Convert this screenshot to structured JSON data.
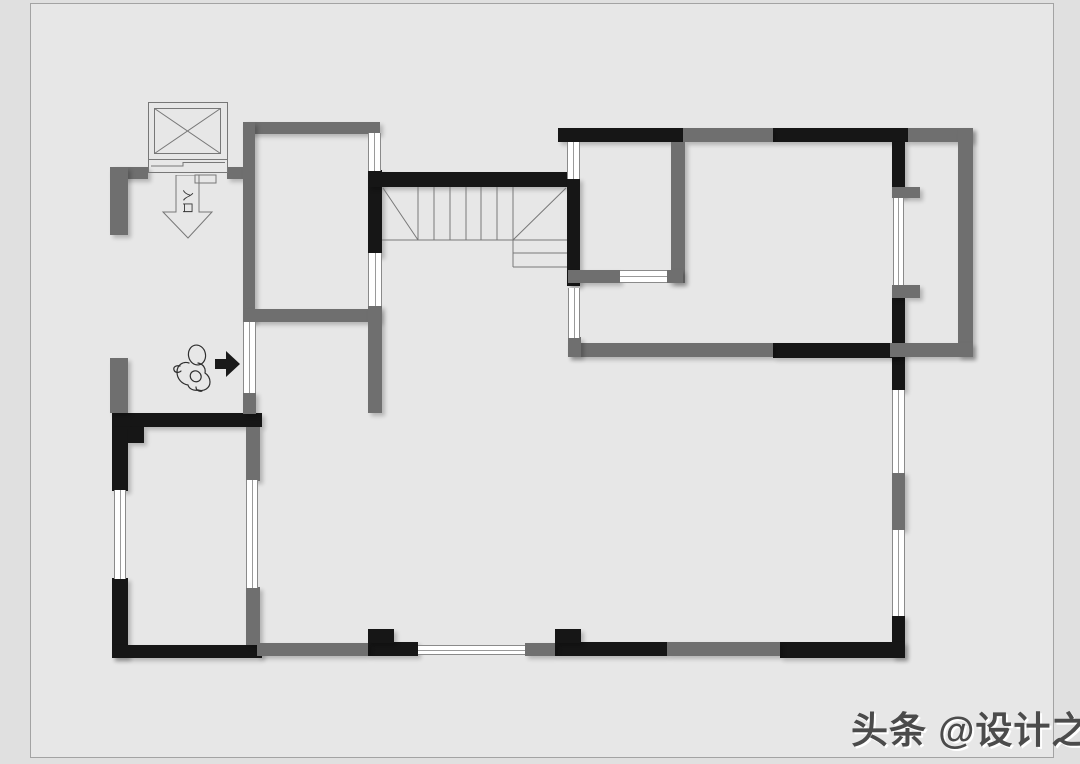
{
  "page": {
    "outer_bg": "#e0e0e0",
    "canvas_bg": "#e7e7e7",
    "canvas_border": "#a3a3a3"
  },
  "palette": {
    "wall_black": "#161616",
    "wall_gray": "#6f6f6f",
    "thin_line": "#777777",
    "window_fill": "#ffffff",
    "arrow_fill": "#1a1a1a",
    "watermark_color": "#4b4b4b"
  },
  "entry": {
    "label": "入口"
  },
  "watermark": {
    "text": "头条 @设计之师"
  },
  "floorplan": {
    "walls_black": [
      [
        368,
        170,
        14,
        86
      ],
      [
        368,
        172,
        205,
        15
      ],
      [
        558,
        128,
        125,
        14
      ],
      [
        567,
        178,
        13,
        108
      ],
      [
        773,
        128,
        135,
        14
      ],
      [
        892,
        142,
        13,
        54
      ],
      [
        892,
        298,
        13,
        93
      ],
      [
        773,
        343,
        125,
        15
      ],
      [
        892,
        615,
        13,
        43
      ],
      [
        780,
        642,
        125,
        16
      ],
      [
        555,
        642,
        112,
        14
      ],
      [
        555,
        629,
        26,
        14
      ],
      [
        368,
        642,
        50,
        14
      ],
      [
        368,
        629,
        26,
        14
      ],
      [
        112,
        413,
        150,
        14
      ],
      [
        112,
        427,
        16,
        64
      ],
      [
        112,
        578,
        16,
        80
      ],
      [
        112,
        645,
        150,
        13
      ],
      [
        128,
        427,
        16,
        16
      ]
    ],
    "walls_gray": [
      [
        110,
        167,
        38,
        12
      ],
      [
        227,
        167,
        16,
        12
      ],
      [
        110,
        167,
        18,
        68
      ],
      [
        243,
        122,
        137,
        12
      ],
      [
        243,
        122,
        12,
        200
      ],
      [
        243,
        309,
        137,
        13
      ],
      [
        243,
        392,
        13,
        22
      ],
      [
        368,
        305,
        14,
        108
      ],
      [
        683,
        128,
        90,
        14
      ],
      [
        908,
        128,
        65,
        14
      ],
      [
        958,
        128,
        15,
        229
      ],
      [
        890,
        343,
        83,
        14
      ],
      [
        892,
        187,
        28,
        11
      ],
      [
        892,
        285,
        28,
        13
      ],
      [
        671,
        142,
        14,
        141
      ],
      [
        568,
        270,
        52,
        13
      ],
      [
        667,
        270,
        16,
        13
      ],
      [
        568,
        343,
        205,
        14
      ],
      [
        568,
        337,
        13,
        20
      ],
      [
        110,
        358,
        18,
        55
      ],
      [
        246,
        427,
        14,
        54
      ],
      [
        246,
        587,
        14,
        58
      ],
      [
        257,
        643,
        111,
        13
      ],
      [
        525,
        643,
        30,
        13
      ],
      [
        667,
        642,
        113,
        14
      ],
      [
        892,
        472,
        13,
        58
      ]
    ],
    "windows": [
      [
        368,
        133,
        13,
        38,
        "v"
      ],
      [
        567,
        142,
        13,
        37,
        "v"
      ],
      [
        620,
        270,
        47,
        13,
        "h"
      ],
      [
        893,
        198,
        11,
        87,
        "v"
      ],
      [
        568,
        288,
        12,
        50,
        "v"
      ],
      [
        892,
        390,
        13,
        83,
        "v"
      ],
      [
        892,
        530,
        13,
        86,
        "v"
      ],
      [
        246,
        480,
        12,
        108,
        "v"
      ],
      [
        114,
        490,
        12,
        89,
        "v"
      ],
      [
        418,
        645,
        107,
        10,
        "h"
      ],
      [
        243,
        322,
        13,
        71,
        "v"
      ],
      [
        368,
        253,
        14,
        53,
        "v"
      ]
    ]
  }
}
